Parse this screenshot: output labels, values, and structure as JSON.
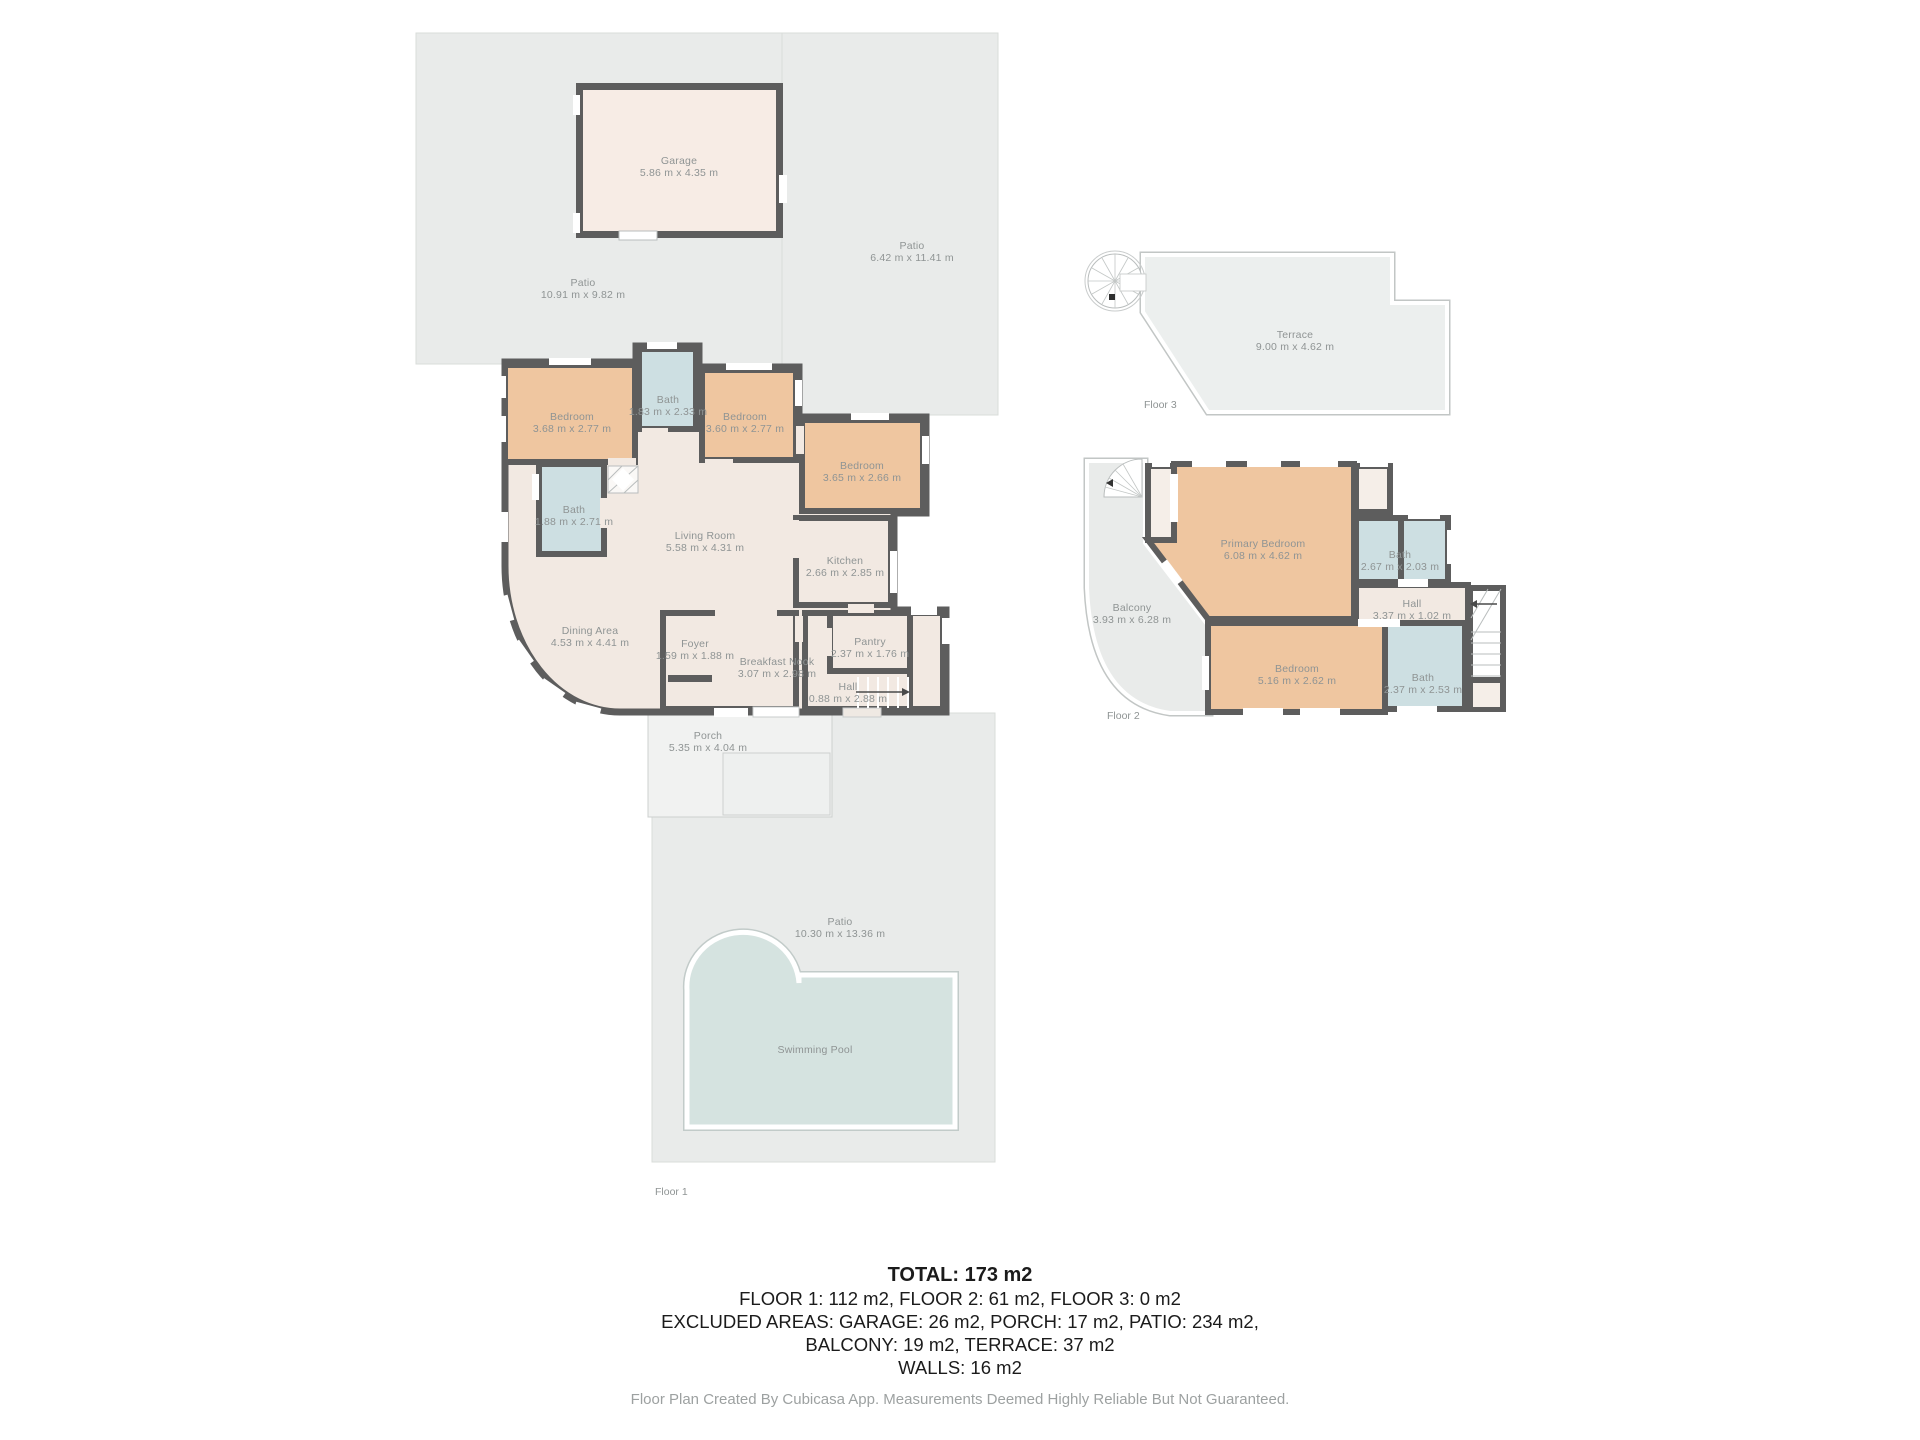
{
  "summary": {
    "total": "TOTAL: 173 m2",
    "line1": "FLOOR 1: 112 m2, FLOOR 2: 61 m2, FLOOR 3: 0 m2",
    "line2": "EXCLUDED AREAS: GARAGE: 26 m2, PORCH: 17 m2, PATIO: 234 m2,",
    "line3": "BALCONY: 19 m2, TERRACE: 37 m2",
    "line4": "WALLS: 16 m2",
    "disclaimer": "Floor Plan Created By Cubicasa App. Measurements Deemed Highly Reliable But Not Guaranteed."
  },
  "floor1": {
    "caption": "Floor 1",
    "rooms": {
      "garage": {
        "name": "Garage",
        "dims": "5.86 m x 4.35 m"
      },
      "patio_nw": {
        "name": "Patio",
        "dims": "10.91 m x 9.82 m"
      },
      "patio_ne": {
        "name": "Patio",
        "dims": "6.42 m x 11.41 m"
      },
      "bedroom_nw": {
        "name": "Bedroom",
        "dims": "3.68 m x 2.77 m"
      },
      "bath_n": {
        "name": "Bath",
        "dims": "1.83 m x 2.33 m"
      },
      "bedroom_n": {
        "name": "Bedroom",
        "dims": "3.60 m x 2.77 m"
      },
      "bedroom_e": {
        "name": "Bedroom",
        "dims": "3.65 m x 2.66 m"
      },
      "bath_w": {
        "name": "Bath",
        "dims": "1.88 m x 2.71 m"
      },
      "living_room": {
        "name": "Living Room",
        "dims": "5.58 m x 4.31 m"
      },
      "kitchen": {
        "name": "Kitchen",
        "dims": "2.66 m x 2.85 m"
      },
      "dining_area": {
        "name": "Dining Area",
        "dims": "4.53 m x 4.41 m"
      },
      "foyer": {
        "name": "Foyer",
        "dims": "1.59 m x 1.88 m"
      },
      "breakfast_nook": {
        "name": "Breakfast Nook",
        "dims": "3.07 m x 2.98 m"
      },
      "pantry": {
        "name": "Pantry",
        "dims": "2.37 m x 1.76 m"
      },
      "hall": {
        "name": "Hall",
        "dims": "0.88 m x 2.88 m"
      },
      "porch": {
        "name": "Porch",
        "dims": "5.35 m x 4.04 m"
      },
      "patio_s": {
        "name": "Patio",
        "dims": "10.30 m x 13.36 m"
      },
      "swimming_pool": {
        "name": "Swimming Pool",
        "dims": ""
      }
    }
  },
  "floor2": {
    "caption": "Floor 2",
    "rooms": {
      "primary_bedroom": {
        "name": "Primary Bedroom",
        "dims": "6.08 m x 4.62 m"
      },
      "bath_upper": {
        "name": "Bath",
        "dims": "2.67 m x 2.03 m"
      },
      "hall": {
        "name": "Hall",
        "dims": "3.37 m x 1.02 m"
      },
      "bedroom": {
        "name": "Bedroom",
        "dims": "5.16 m x 2.62 m"
      },
      "bath_lower": {
        "name": "Bath",
        "dims": "2.37 m x 2.53 m"
      },
      "balcony": {
        "name": "Balcony",
        "dims": "3.93 m x 6.28 m"
      }
    }
  },
  "floor3": {
    "caption": "Floor 3",
    "rooms": {
      "terrace": {
        "name": "Terrace",
        "dims": "9.00 m x 4.62 m"
      }
    }
  },
  "colors": {
    "wall": "#5d5d5d",
    "room_floor": "#f2e9e2",
    "bedroom_floor": "#efc6a0",
    "bath_floor": "#cddfe2",
    "garage_floor": "#f7ece5",
    "patio": "#e9ebea",
    "pool": "#d5e3e0",
    "label_text": "#8f9494",
    "summary_text": "#1b1b1b",
    "disclaimer_text": "#9da1a1"
  }
}
